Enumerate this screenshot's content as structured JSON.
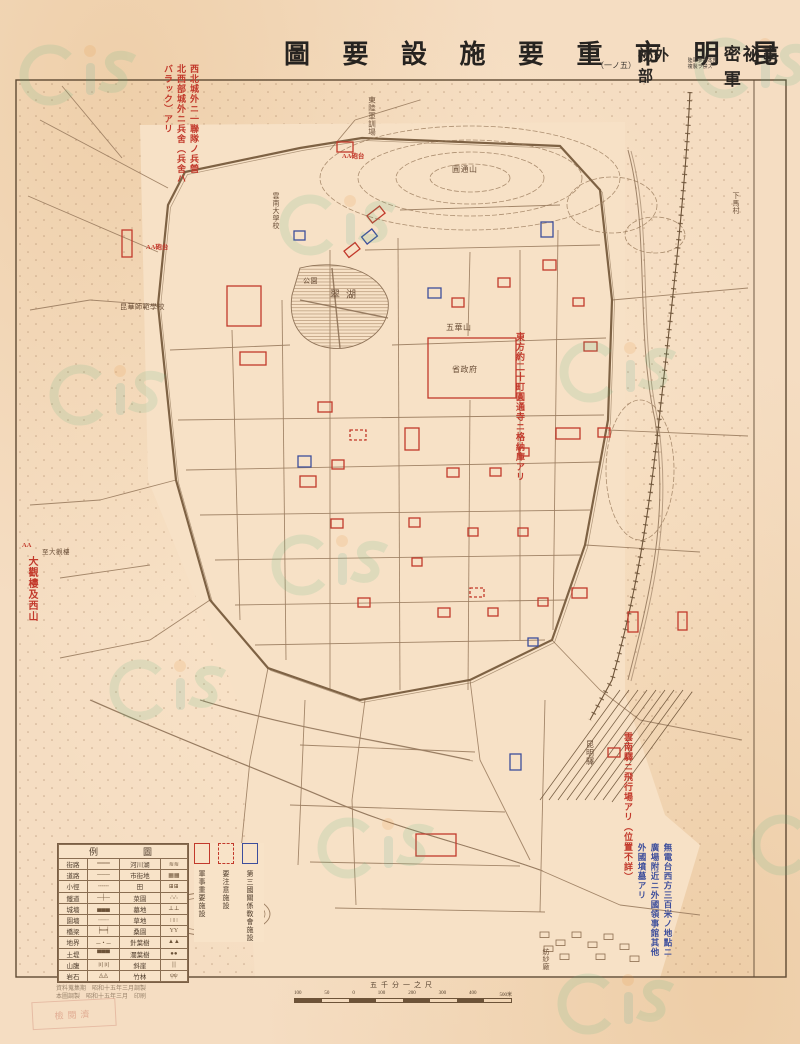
{
  "header": {
    "title_display": "圖 要 設 施 要 重 市 明 昆",
    "classification": {
      "stamp": "密祕事軍",
      "secondary": "祕外部",
      "bracket_left": "（一ノ五）",
      "note_small_1": "陸軍參謀本部",
      "note_small_2": "複製ヲ禁ズ"
    }
  },
  "colors": {
    "paper": "#f5ddc2",
    "ink": "#6d5338",
    "frame": "#5f4a33",
    "red": "#c2392b",
    "blue": "#3d4e9c",
    "watermark_green": "#57b583",
    "watermark_teal": "#4fae9b",
    "watermark_orange": "#e8923c"
  },
  "legend": {
    "header_display": "例　圖",
    "rows": [
      {
        "l": "街路",
        "ls": "═══",
        "r": "河川湖",
        "rs": "≋≋"
      },
      {
        "l": "道路",
        "ls": "───",
        "r": "市街地",
        "rs": "▦▦"
      },
      {
        "l": "小徑",
        "ls": "╌╌╌",
        "r": "田",
        "rs": "⊞⊞"
      },
      {
        "l": "鐵道",
        "ls": "─┼─",
        "r": "菜園",
        "rs": "∴∴"
      },
      {
        "l": "城墻",
        "ls": "▄▄▄",
        "r": "墓地",
        "rs": "⊥⊥"
      },
      {
        "l": "園墻",
        "ls": "┈┈┈",
        "r": "草地",
        "rs": "∷∷"
      },
      {
        "l": "橋梁",
        "ls": "╞═╡",
        "r": "桑園",
        "rs": "YY"
      },
      {
        "l": "地界",
        "ls": "─・─",
        "r": "針葉樹",
        "rs": "▲▲"
      },
      {
        "l": "土堤",
        "ls": "▀▀▀",
        "r": "濶葉樹",
        "rs": "●●"
      },
      {
        "l": "山腹",
        "ls": "〣〣",
        "r": "斜崖",
        "rs": "|||"
      },
      {
        "l": "岩石",
        "ls": "◬◬",
        "r": "竹林",
        "rs": "ψψ"
      }
    ]
  },
  "facility_key": {
    "items": [
      {
        "label": "軍事重要施設",
        "style": "red-solid"
      },
      {
        "label": "要注意施設",
        "style": "red-dashed"
      },
      {
        "label": "第三國關係敎會施設",
        "style": "blue-solid"
      }
    ]
  },
  "scale": {
    "label": "五千分一之尺",
    "ticks": [
      "100",
      "50",
      "0",
      "100",
      "200",
      "300",
      "400",
      "500米"
    ]
  },
  "imprint": {
    "line1": "資料蒐集期　昭和十五年三月調製",
    "line2": "本圖調製　昭和十五年三月　印刷"
  },
  "stamp_text": "檢閱濟",
  "annotations": [
    {
      "color": "red",
      "x": 160,
      "y": 64,
      "h": 132,
      "fs": 9,
      "lines": [
        "西北城外ニ一聯隊ノ兵營",
        "北西部城外ニ兵舍（兵舍ハ",
        "バラック）アリ"
      ]
    },
    {
      "color": "red",
      "x": 512,
      "y": 332,
      "h": 195,
      "fs": 9,
      "lines": [
        "東方約二十町圓通寺ニ格納庫アリ"
      ]
    },
    {
      "color": "red",
      "x": 24,
      "y": 556,
      "h": 110,
      "fs": 10,
      "lines": [
        "大觀樓及西山"
      ]
    },
    {
      "color": "red",
      "x": 620,
      "y": 732,
      "h": 228,
      "fs": 9,
      "lines": [
        "雲南驛ニ飛行場アリ（位置不詳）"
      ]
    },
    {
      "color": "blue",
      "x": 634,
      "y": 843,
      "h": 150,
      "fs": 8.5,
      "lines": [
        "無電台西方三百米ノ地點ニ",
        "廣場附近ニ外國領事館其他",
        "外國墳墓アリ"
      ]
    }
  ],
  "small_red_marks": [
    {
      "t": "AA砲台",
      "x": 146,
      "y": 241
    },
    {
      "t": "AA砲台",
      "x": 342,
      "y": 150
    },
    {
      "t": "AA",
      "x": 22,
      "y": 542
    }
  ],
  "map": {
    "labels": [
      {
        "t": "東陸軍訓場",
        "x": 372,
        "y": 96,
        "v": true,
        "s": 7.5
      },
      {
        "t": "圓通山",
        "x": 452,
        "y": 172,
        "v": false,
        "s": 8
      },
      {
        "t": "下馬村",
        "x": 736,
        "y": 192,
        "v": true,
        "s": 7
      },
      {
        "t": "雲南大學校",
        "x": 276,
        "y": 192,
        "v": true,
        "s": 7
      },
      {
        "t": "翠湖",
        "x": 330,
        "y": 298,
        "v": false,
        "s": 10
      },
      {
        "t": "公園",
        "x": 303,
        "y": 283,
        "v": false,
        "s": 7
      },
      {
        "t": "昆華師範學校",
        "x": 120,
        "y": 309,
        "v": false,
        "s": 7
      },
      {
        "t": "五華山",
        "x": 446,
        "y": 330,
        "v": false,
        "s": 8
      },
      {
        "t": "省政府",
        "x": 452,
        "y": 372,
        "v": false,
        "s": 8
      },
      {
        "t": "至大觀樓",
        "x": 42,
        "y": 554,
        "v": false,
        "s": 6.5
      },
      {
        "t": "昆明驛",
        "x": 590,
        "y": 740,
        "v": true,
        "s": 8
      },
      {
        "t": "紡紗廠",
        "x": 546,
        "y": 948,
        "v": true,
        "s": 7
      }
    ],
    "red_boxes": [
      [
        337,
        142,
        16,
        10,
        0,
        0
      ],
      [
        122,
        230,
        10,
        27,
        0,
        0
      ],
      [
        227,
        286,
        34,
        40,
        0,
        0
      ],
      [
        240,
        352,
        26,
        13,
        0,
        0
      ],
      [
        318,
        402,
        14,
        10,
        0,
        0
      ],
      [
        300,
        476,
        16,
        11,
        0,
        0
      ],
      [
        332,
        460,
        12,
        9,
        0,
        0
      ],
      [
        331,
        519,
        12,
        9,
        0,
        0
      ],
      [
        405,
        428,
        14,
        22,
        0,
        0
      ],
      [
        428,
        338,
        88,
        60,
        0,
        0
      ],
      [
        452,
        298,
        12,
        9,
        0,
        0
      ],
      [
        498,
        278,
        12,
        9,
        0,
        0
      ],
      [
        543,
        260,
        13,
        10,
        0,
        0
      ],
      [
        573,
        298,
        11,
        8,
        0,
        0
      ],
      [
        584,
        342,
        13,
        9,
        0,
        0
      ],
      [
        447,
        468,
        12,
        9,
        0,
        0
      ],
      [
        490,
        468,
        11,
        8,
        0,
        0
      ],
      [
        519,
        448,
        10,
        8,
        0,
        0
      ],
      [
        556,
        428,
        24,
        11,
        0,
        0
      ],
      [
        598,
        428,
        12,
        9,
        0,
        0
      ],
      [
        409,
        518,
        11,
        9,
        0,
        0
      ],
      [
        468,
        528,
        10,
        8,
        0,
        0
      ],
      [
        518,
        528,
        10,
        8,
        0,
        0
      ],
      [
        412,
        558,
        10,
        8,
        0,
        0
      ],
      [
        358,
        598,
        12,
        9,
        0,
        0
      ],
      [
        438,
        608,
        12,
        9,
        0,
        0
      ],
      [
        488,
        608,
        10,
        8,
        0,
        0
      ],
      [
        538,
        598,
        10,
        8,
        0,
        0
      ],
      [
        572,
        588,
        15,
        10,
        0,
        0
      ],
      [
        628,
        612,
        10,
        20,
        0,
        0
      ],
      [
        678,
        612,
        9,
        18,
        0,
        0
      ],
      [
        416,
        834,
        40,
        22,
        0,
        0
      ],
      [
        608,
        748,
        12,
        9,
        0,
        0
      ],
      [
        368,
        210,
        16,
        9,
        -38,
        0
      ],
      [
        345,
        246,
        14,
        8,
        -38,
        0
      ],
      [
        350,
        430,
        16,
        10,
        0,
        1
      ],
      [
        470,
        588,
        14,
        9,
        0,
        1
      ]
    ],
    "blue_boxes": [
      [
        294,
        231,
        11,
        9,
        0
      ],
      [
        363,
        232,
        13,
        9,
        -38
      ],
      [
        428,
        288,
        13,
        10,
        0
      ],
      [
        541,
        222,
        12,
        15,
        0
      ],
      [
        298,
        456,
        13,
        11,
        0
      ],
      [
        510,
        754,
        11,
        16,
        0
      ],
      [
        528,
        638,
        10,
        8,
        0
      ]
    ],
    "streets": [
      [
        40,
        120,
        168,
        188
      ],
      [
        28,
        196,
        158,
        252
      ],
      [
        62,
        86,
        122,
        158
      ],
      [
        330,
        150,
        355,
        120
      ],
      [
        355,
        120,
        420,
        100
      ],
      [
        398,
        238,
        400,
        690
      ],
      [
        330,
        250,
        330,
        690
      ],
      [
        470,
        252,
        468,
        336
      ],
      [
        470,
        400,
        468,
        690
      ],
      [
        520,
        250,
        520,
        640
      ],
      [
        558,
        230,
        553,
        630
      ],
      [
        282,
        300,
        286,
        660
      ],
      [
        232,
        330,
        240,
        620
      ],
      [
        170,
        350,
        290,
        345
      ],
      [
        392,
        345,
        606,
        338
      ],
      [
        178,
        420,
        604,
        415
      ],
      [
        186,
        470,
        600,
        462
      ],
      [
        200,
        515,
        590,
        510
      ],
      [
        215,
        560,
        580,
        555
      ],
      [
        235,
        605,
        565,
        600
      ],
      [
        255,
        645,
        545,
        640
      ],
      [
        365,
        250,
        600,
        245
      ],
      [
        400,
        210,
        560,
        205
      ],
      [
        612,
        300,
        748,
        288
      ],
      [
        608,
        430,
        748,
        436
      ],
      [
        585,
        545,
        700,
        552
      ],
      [
        640,
        720,
        742,
        740
      ],
      [
        158,
        305,
        90,
        300
      ],
      [
        90,
        300,
        30,
        310
      ],
      [
        176,
        480,
        100,
        500
      ],
      [
        100,
        500,
        30,
        505
      ],
      [
        150,
        565,
        60,
        578
      ],
      [
        210,
        600,
        150,
        640
      ],
      [
        150,
        640,
        60,
        658
      ],
      [
        268,
        668,
        250,
        760
      ],
      [
        250,
        760,
        240,
        860
      ],
      [
        240,
        860,
        250,
        930
      ],
      [
        365,
        700,
        352,
        800
      ],
      [
        352,
        800,
        356,
        905
      ],
      [
        470,
        680,
        480,
        760
      ],
      [
        480,
        760,
        510,
        820
      ],
      [
        510,
        820,
        530,
        860
      ],
      [
        300,
        745,
        475,
        752
      ],
      [
        290,
        805,
        505,
        812
      ],
      [
        310,
        862,
        520,
        866
      ],
      [
        335,
        908,
        545,
        912
      ],
      [
        305,
        700,
        298,
        865
      ],
      [
        545,
        700,
        540,
        912
      ],
      [
        552,
        640,
        600,
        690
      ],
      [
        600,
        690,
        640,
        720
      ],
      [
        540,
        870,
        620,
        905
      ],
      [
        620,
        905,
        700,
        915
      ]
    ],
    "wall": "M158,305 L168,205 L185,172 L300,148 L362,138 L560,146 L600,190 L612,300 L608,420 L585,545 L552,640 L470,680 L360,700 L268,668 L210,600 L176,480 Z",
    "clear": "M140,125 L625,122 L625,695 L665,815 L700,845 L660,978 L255,978 L238,700 L148,480 Z",
    "railway_main": "M690,92 C685,200 670,320 658,430 C648,520 635,600 612,680 L590,720",
    "railway_fan": [
      [
        620,
        690,
        540,
        800
      ],
      [
        629,
        690,
        549,
        800
      ],
      [
        638,
        690,
        558,
        800
      ],
      [
        647,
        690,
        567,
        800
      ],
      [
        656,
        690,
        576,
        800
      ],
      [
        665,
        690,
        585,
        800
      ],
      [
        674,
        690,
        594,
        800
      ],
      [
        683,
        690,
        603,
        800
      ],
      [
        692,
        692,
        612,
        802
      ]
    ],
    "rivers": [
      "M628,150 C650,230 635,330 655,420 C670,520 648,600 628,680",
      "M90,700 C180,740 260,770 330,800 C400,830 470,845 540,870",
      "M200,700 C300,730 380,740 470,760"
    ],
    "contours": [
      [
        470,
        178,
        150,
        52
      ],
      [
        470,
        178,
        112,
        38
      ],
      [
        470,
        178,
        74,
        26
      ],
      [
        470,
        178,
        40,
        14
      ],
      [
        612,
        205,
        45,
        28
      ],
      [
        655,
        235,
        30,
        18
      ],
      [
        640,
        470,
        34,
        70
      ]
    ],
    "lake": "M300,268 C340,258 380,272 388,300 C392,330 360,352 330,348 C300,344 288,322 292,295 Z",
    "lake_causeways": [
      [
        300,
        300,
        388,
        318
      ],
      [
        332,
        268,
        340,
        348
      ]
    ],
    "oval": [
      215,
      914,
      55,
      22
    ],
    "houses": [
      [
        540,
        932
      ],
      [
        556,
        940
      ],
      [
        572,
        932
      ],
      [
        588,
        942
      ],
      [
        604,
        934
      ],
      [
        620,
        944
      ],
      [
        560,
        954
      ],
      [
        596,
        954
      ],
      [
        630,
        956
      ],
      [
        544,
        946
      ]
    ],
    "watermarks": [
      [
        50,
        75
      ],
      [
        310,
        225
      ],
      [
        725,
        68
      ],
      [
        80,
        395
      ],
      [
        590,
        372
      ],
      [
        140,
        690
      ],
      [
        348,
        848
      ],
      [
        588,
        1004
      ],
      [
        782,
        845
      ],
      [
        302,
        565
      ]
    ]
  }
}
